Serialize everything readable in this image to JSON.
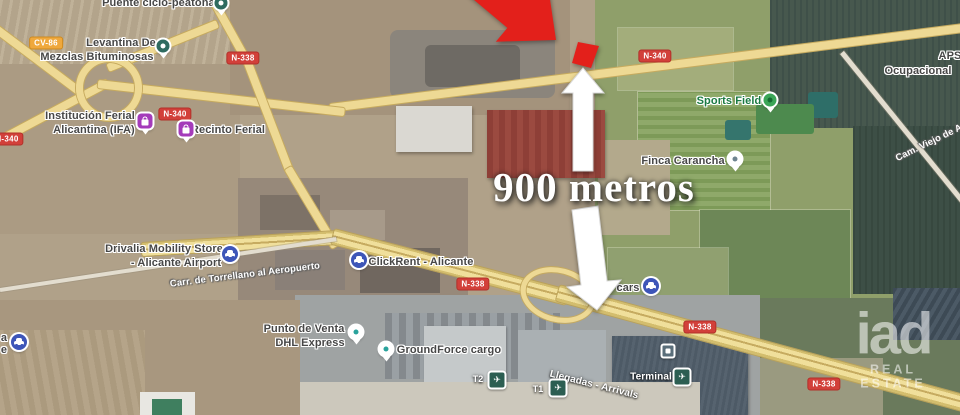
{
  "annotation": {
    "distance_label": "900 metros"
  },
  "watermark": {
    "brand": "iad",
    "tagline": "REAL ESTATE"
  },
  "icons": {
    "airplane": "✈"
  },
  "colors": {
    "highlight_red": "#e3201b",
    "arrow_white": "#ffffff",
    "road_badge_red": "#d2403a",
    "road_badge_orange": "#efa83c",
    "road_yellow": "#eed994",
    "label_green": "#1a7a43"
  },
  "roads": {
    "badge_cv86": "CV-86",
    "badge_n338": "N-338",
    "badge_n340": "N-340",
    "name_torrellano": "Carr. de Torrellano al Aeropuerto",
    "name_camviejo": "Cam. Viejo de A"
  },
  "pois": {
    "puente": {
      "label": "Puente ciclo-peatonal"
    },
    "levantina": {
      "line1": "Levantina De",
      "line2": "Mezclas Bituminosas"
    },
    "ifa": {
      "line1": "Institución Ferial",
      "line2": "Alicantina (IFA)"
    },
    "recinto": {
      "label": "Recinto Ferial"
    },
    "sports": {
      "label": "Sports Field"
    },
    "aps": {
      "line1": "APS",
      "line2": "Ocupacional"
    },
    "finca": {
      "label": "Finca Carancha"
    },
    "drivalia": {
      "line1": "Drivalia Mobility Store",
      "line2": "- Alicante Airport"
    },
    "clickrent": {
      "label": "ClickRent - Alicante"
    },
    "cars": {
      "label": "cars"
    },
    "punto": {
      "line1": "Punto de Venta",
      "line2": "DHL Express"
    },
    "groundforce": {
      "label": "GroundForce cargo"
    },
    "terminal": {
      "label": "Terminal"
    },
    "t2": {
      "label": "T2"
    },
    "t1": {
      "label": "T1"
    },
    "llegadas": {
      "label": "Llegadas - Arrivals"
    },
    "edge_partial": {
      "line1": "a",
      "line2": "e"
    }
  }
}
